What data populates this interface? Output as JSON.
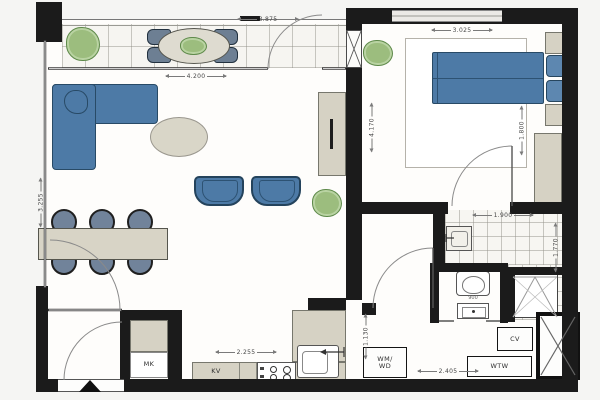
{
  "title": "apartment-floor-plan",
  "labels": {
    "mk": "MK",
    "kv": "KV",
    "wm_wd": "WM/\nWD",
    "cv": "CV",
    "wtw": "WTW"
  },
  "dimensions": {
    "balcony_width": "3.875",
    "living_width": "4.200",
    "bedroom_width": "3.025",
    "bathroom_width": "1.900",
    "kitchen_width": "2.255",
    "hall_width": "2.405",
    "living_depth": "3.255",
    "bedroom_depth": "4.170",
    "bed_zone": "1.800",
    "bathroom_depth": "1.770",
    "hall_depth": "1.130",
    "wc_width": "900"
  },
  "colors": {
    "wall": "#1b1b1b",
    "furniture_blue": "#4d7aa6",
    "furniture_blue_dark": "#284a66",
    "cabinet_beige": "#d6d2c4",
    "plant_green": "#9cbd7e",
    "floor": "#fefdfb",
    "tile_line": "#c9c6c0"
  }
}
